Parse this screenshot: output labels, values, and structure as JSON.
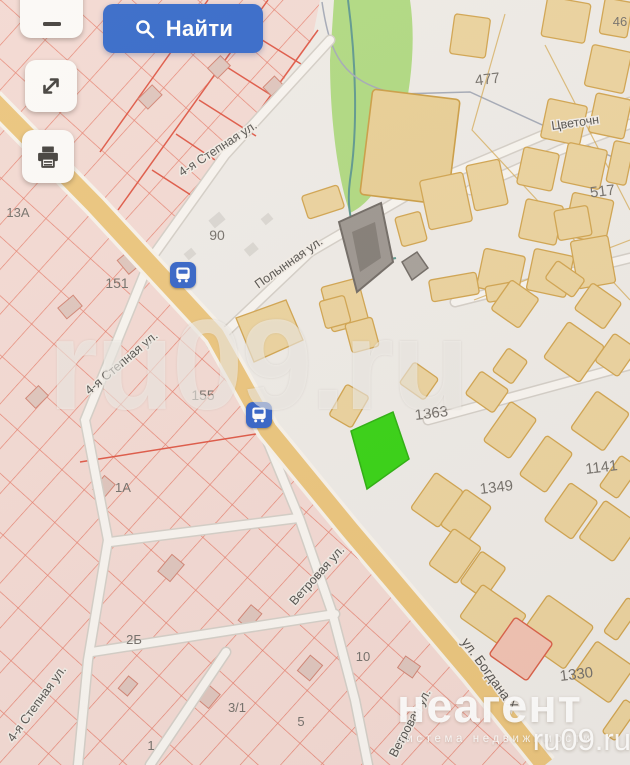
{
  "controls": {
    "find_label": "Найти",
    "icons": {
      "search": "magnifier",
      "zoom_out": "minus",
      "expand": "resize-diagonal-arrows",
      "print": "printer",
      "transit_stop": "bus-stop"
    }
  },
  "map": {
    "streets": {
      "stepnaya": "4-я Степная ул.",
      "polynnaya": "Полынная ул.",
      "vetrovaya": "Ветровая ул.",
      "bogdana": "ул. Богдана Х",
      "tsvetochnaya": "Цветочн"
    },
    "numbers": {
      "n13a": "13А",
      "n151": "151",
      "n90": "90",
      "n155": "155",
      "n1a": "1А",
      "n2b": "2Б",
      "n31": "3/1",
      "n5": "5",
      "n1": "1",
      "n10": "10",
      "n46": "46",
      "n477": "477",
      "n517": "517",
      "n1363": "1363",
      "n1349": "1349",
      "n1141": "1141",
      "n1330": "1330"
    },
    "highlighted_parcel_color": "#2fd10c",
    "accent_color": "#2c63c8",
    "parcel_line_color": "#e05a45",
    "building_fill_color": "#ead19b",
    "road_color": "#eac379",
    "park_color": "#acd87d"
  },
  "watermark": {
    "big": "ru09.ru"
  },
  "logo": {
    "brand": "неагент",
    "tagline": "система недвижимости",
    "site": "ru09.ru"
  }
}
